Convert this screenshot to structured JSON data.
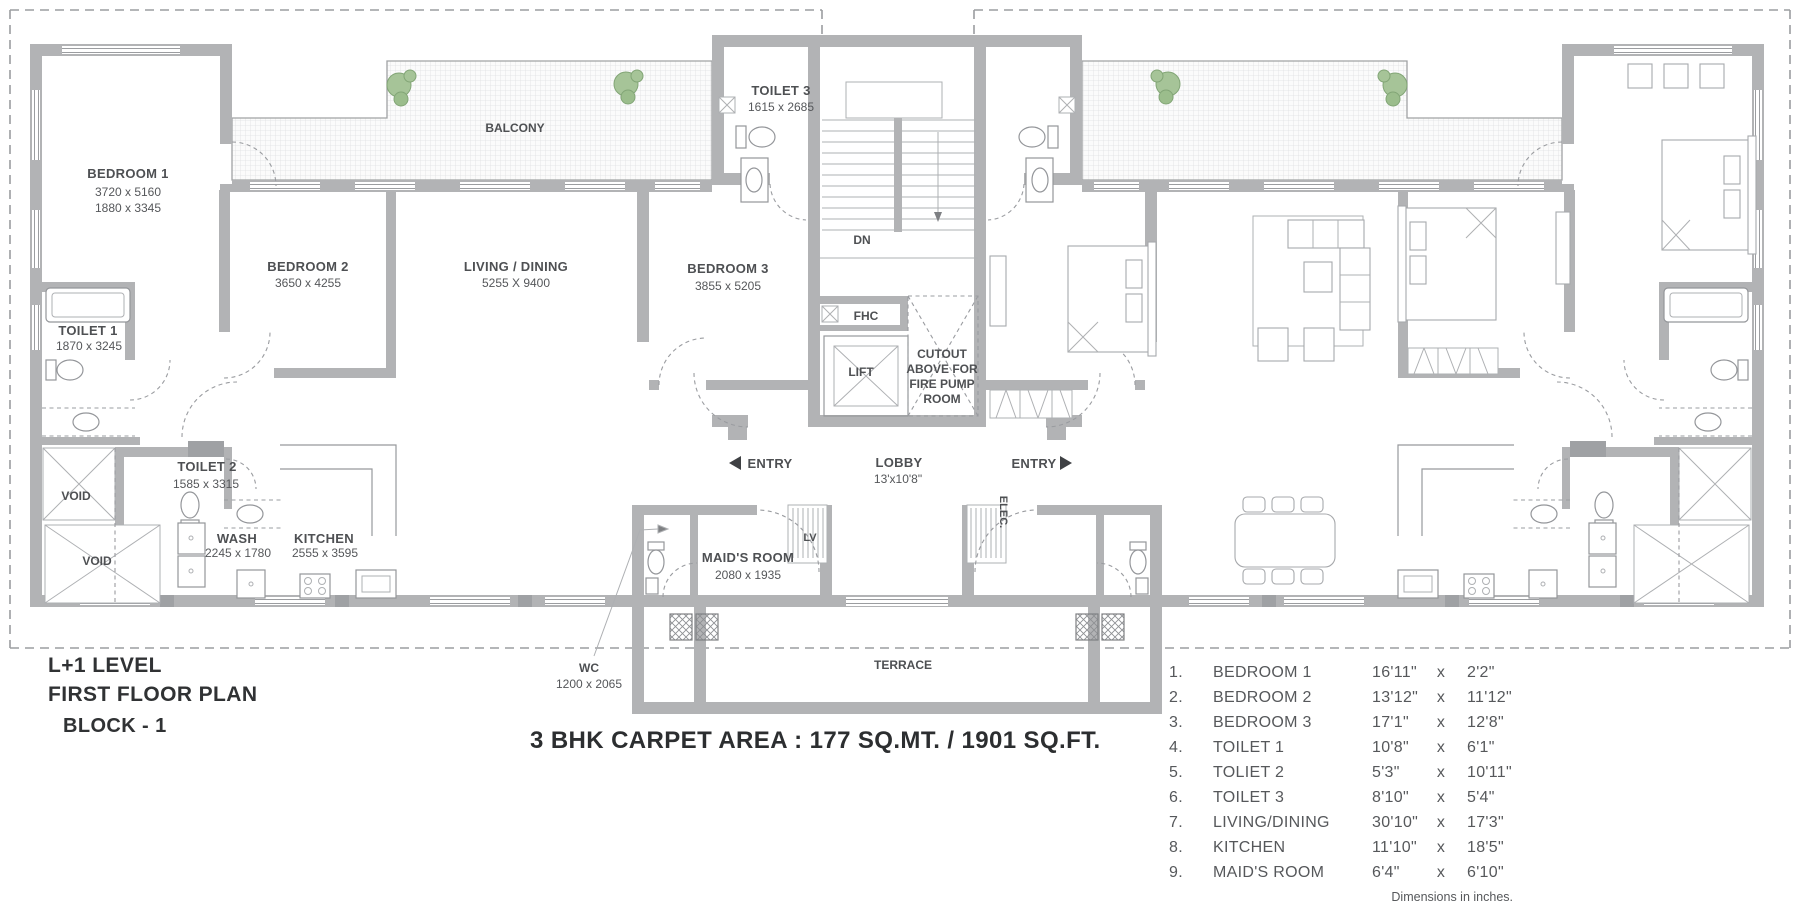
{
  "plan": {
    "titles": {
      "level": "L+1 LEVEL",
      "plan": "FIRST FLOOR PLAN",
      "block": "BLOCK - 1",
      "area": "3 BHK CARPET AREA : 177 SQ.MT. / 1901 SQ.FT."
    },
    "labels": {
      "bedroom1": {
        "name": "BEDROOM 1",
        "dim1": "3720 x 5160",
        "dim2": "1880 x 3345"
      },
      "balcony": {
        "name": "BALCONY"
      },
      "toilet3": {
        "name": "TOILET 3",
        "dim": "1615 x 2685"
      },
      "dn": "DN",
      "bedroom2": {
        "name": "BEDROOM 2",
        "dim": "3650 x 4255"
      },
      "living": {
        "name": "LIVING / DINING",
        "dim": "5255 X 9400"
      },
      "bedroom3": {
        "name": "BEDROOM 3",
        "dim": "3855 x 5205"
      },
      "toilet1": {
        "name": "TOILET 1",
        "dim": "1870 x 3245"
      },
      "toilet2": {
        "name": "TOILET 2",
        "dim": "1585 x 3315"
      },
      "fhc": "FHC",
      "lift": "LIFT",
      "cutout": {
        "l1": "CUTOUT",
        "l2": "ABOVE FOR",
        "l3": "FIRE PUMP",
        "l4": "ROOM"
      },
      "entry_left": "ENTRY",
      "entry_right": "ENTRY",
      "lobby": {
        "name": "LOBBY",
        "dim": "13'x10'8\""
      },
      "void1": "VOID",
      "void2": "VOID",
      "wash": {
        "name": "WASH",
        "dim": "2245 x 1780"
      },
      "kitchen": {
        "name": "KITCHEN",
        "dim": "2555 x 3595"
      },
      "maids": {
        "name": "MAID'S ROOM",
        "dim": "2080 x 1935"
      },
      "wc": {
        "name": "WC",
        "dim": "1200 x 2065"
      },
      "lv": "LV",
      "elec": "ELEC.",
      "terrace": "TERRACE"
    },
    "legend": {
      "rows": [
        {
          "num": "1.",
          "name": "BEDROOM 1",
          "w": "16'11\"",
          "x": "x",
          "h": "2'2\""
        },
        {
          "num": "2.",
          "name": "BEDROOM 2",
          "w": "13'12\"",
          "x": "x",
          "h": "11'12\""
        },
        {
          "num": "3.",
          "name": "BEDROOM 3",
          "w": "17'1\"",
          "x": "x",
          "h": "12'8\""
        },
        {
          "num": "4.",
          "name": "TOILET 1",
          "w": "10'8\"",
          "x": "x",
          "h": "6'1\""
        },
        {
          "num": "5.",
          "name": "TOLIET 2",
          "w": "5'3\"",
          "x": "x",
          "h": "10'11\""
        },
        {
          "num": "6.",
          "name": "TOILET 3",
          "w": "8'10\"",
          "x": "x",
          "h": "5'4\""
        },
        {
          "num": "7.",
          "name": "LIVING/DINING",
          "w": "30'10\"",
          "x": "x",
          "h": "17'3\""
        },
        {
          "num": "8.",
          "name": "KITCHEN",
          "w": "11'10\"",
          "x": "x",
          "h": "18'5\""
        },
        {
          "num": "9.",
          "name": "MAID'S ROOM",
          "w": "6'4\"",
          "x": "x",
          "h": "6'10\""
        }
      ],
      "note": "Dimensions in inches."
    },
    "colors": {
      "wall": "#b2b3b5",
      "plant": "#a6c498",
      "text": "#4e5053",
      "title": "#303234"
    }
  }
}
